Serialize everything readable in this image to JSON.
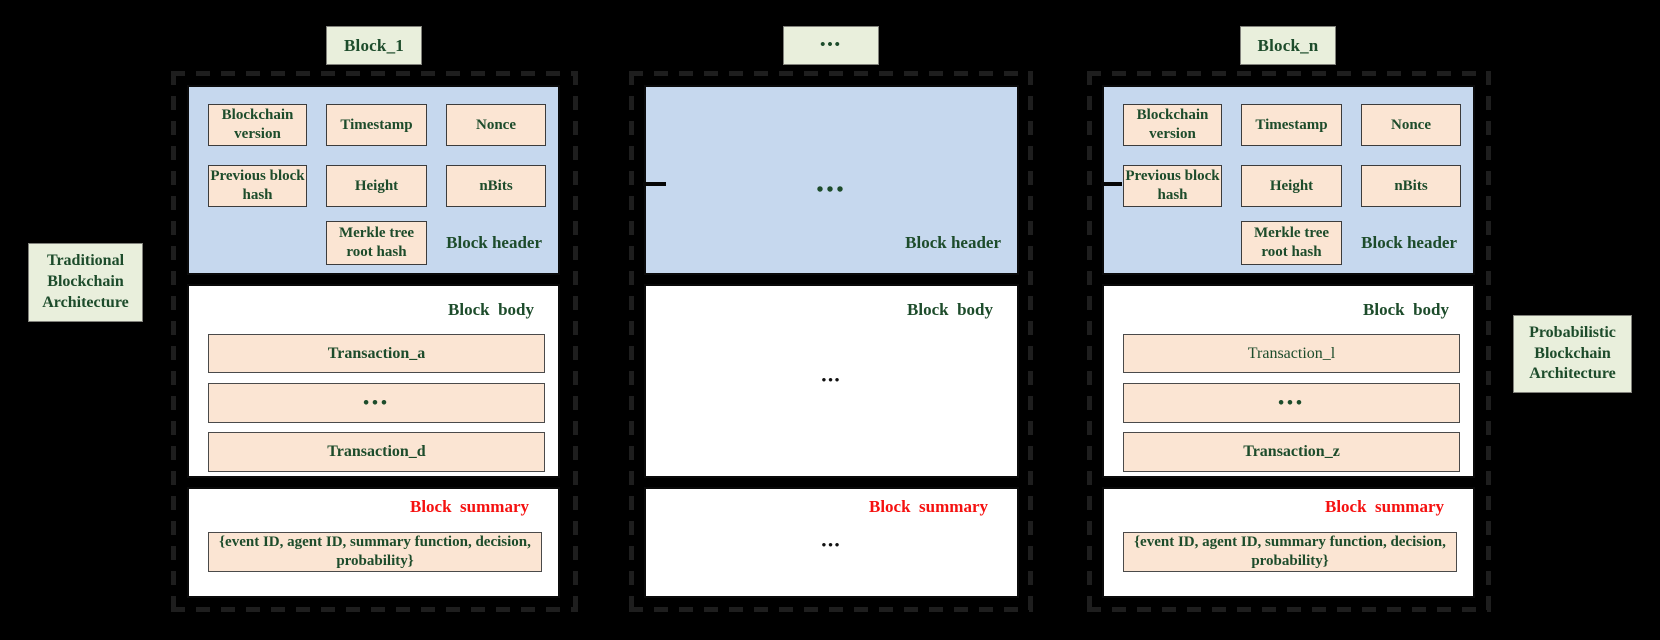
{
  "labels": {
    "left_architecture": "Traditional Blockchain Architecture",
    "right_architecture": "Probabilistic Blockchain Architecture"
  },
  "blocks": [
    {
      "tab": "Block_1",
      "header": {
        "label": "Block header",
        "fields": [
          "Blockchain version",
          "Timestamp",
          "Nonce",
          "Previous block hash",
          "Height",
          "nBits",
          "Merkle tree root hash"
        ]
      },
      "body": {
        "label": "Block  body",
        "transactions": [
          "Transaction_a",
          "•••",
          "Transaction_d"
        ]
      },
      "summary": {
        "label": "Block  summary",
        "content": "{event ID, agent ID, summary function, decision, probability}"
      }
    },
    {
      "tab": "•••",
      "header": {
        "label": "Block header",
        "ellipsis": "•••"
      },
      "body": {
        "label": "Block  body",
        "ellipsis": "•••"
      },
      "summary": {
        "label": "Block  summary",
        "ellipsis": "•••"
      }
    },
    {
      "tab": "Block_n",
      "header": {
        "label": "Block header",
        "fields": [
          "Blockchain version",
          "Timestamp",
          "Nonce",
          "Previous block hash",
          "Height",
          "nBits",
          "Merkle tree root hash"
        ]
      },
      "body": {
        "label": "Block  body",
        "transactions": [
          "Transaction_l",
          "•••",
          "Transaction_z"
        ]
      },
      "summary": {
        "label": "Block  summary",
        "content": "{event ID, agent ID, summary function, decision, probability}"
      }
    }
  ],
  "colors": {
    "background": "#000000",
    "header_fill": "#c6d8ee",
    "field_fill": "#fbe5d3",
    "label_fill": "#e9efdc",
    "green_text": "#1d4c2b",
    "summary_label": "#f51110"
  }
}
